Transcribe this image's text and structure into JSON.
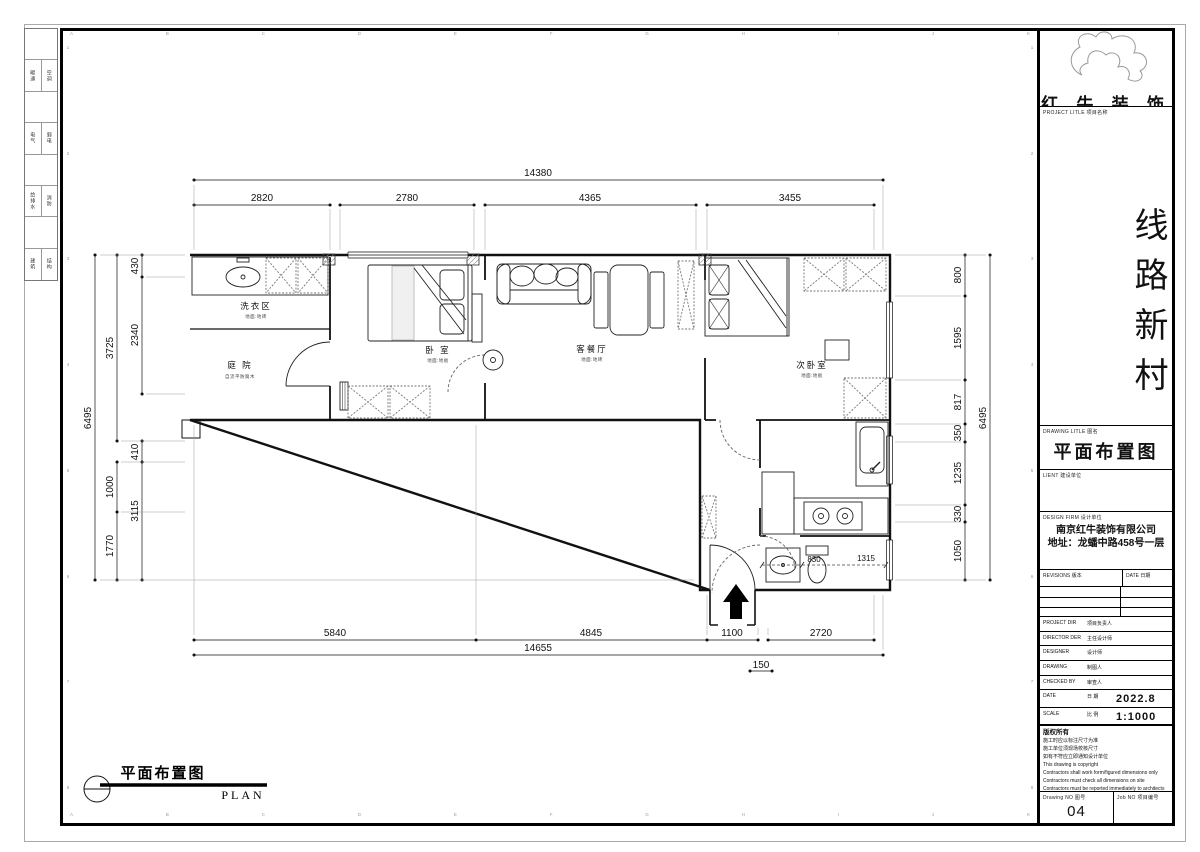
{
  "sign_strip": {
    "rows": [
      {
        "left": "暖通",
        "right": "空调"
      },
      {
        "left": "电气",
        "right": "弱电"
      },
      {
        "left": "给排水",
        "right": "消防"
      },
      {
        "left": "建筑",
        "right": "结构"
      }
    ]
  },
  "frame": {
    "top_letters": [
      "A",
      "B",
      "C",
      "D",
      "E",
      "F",
      "G",
      "H",
      "I",
      "J",
      "K"
    ],
    "bottom_letters": [
      "A",
      "B",
      "C",
      "D",
      "E",
      "F",
      "G",
      "H",
      "I",
      "J",
      "K"
    ],
    "left_numbers": [
      "1",
      "2",
      "3",
      "4",
      "5",
      "6",
      "7",
      "8"
    ],
    "right_numbers": [
      "1",
      "2",
      "3",
      "4",
      "5",
      "6",
      "7",
      "8"
    ]
  },
  "plan": {
    "rooms": [
      {
        "name": "洗衣区",
        "finish": "地面:地砖"
      },
      {
        "name": "庭 院",
        "finish": "自流平防腐木"
      },
      {
        "name": "卧 室",
        "finish": "地面:地板"
      },
      {
        "name": "客餐厅",
        "finish": "地面:地砖"
      },
      {
        "name": "次卧室",
        "finish": "地面:地板"
      }
    ],
    "dims": {
      "top_total": "14380",
      "top_segments": [
        "2820",
        "2780",
        "4365",
        "3455"
      ],
      "left_total": "6495",
      "left_mid": [
        "3725",
        "1000",
        "1770"
      ],
      "left_inner": [
        "430",
        "2340",
        "410",
        "3115"
      ],
      "right_total": "6495",
      "right_inner": [
        "800",
        "1595",
        "817",
        "350",
        "1235",
        "330",
        "1050"
      ],
      "bottom_segments": [
        "5840",
        "4845",
        "1100",
        "2720"
      ],
      "bottom_total": "14655",
      "bottom_offset": "150",
      "interior": [
        "830",
        "1315"
      ]
    },
    "caption": {
      "zh": "平面布置图",
      "en": "PLAN"
    }
  },
  "title_block": {
    "logo_text": "红 牛 装 饰",
    "project_title_label": "PROJECT LITLE 项目名称",
    "project_name": "线路新村",
    "drawing_title_label": "DRAWING LITLE 图名",
    "drawing_title": "平面布置图",
    "client_label": "LIENT 建设单位",
    "design_firm_label": "DESIGN FIRM 设计单位",
    "firm_name": "南京红牛装饰有限公司",
    "firm_address": "地址：龙蟠中路458号一层",
    "revisions_label": "REVISIONS 版本",
    "date_col_label": "DATE 日期",
    "rows": [
      {
        "en": "PROJECT DIR",
        "zh": "项目负责人",
        "value": ""
      },
      {
        "en": "DIRECTOR DER",
        "zh": "主任设计师",
        "value": ""
      },
      {
        "en": "DESIGNER",
        "zh": "设计师",
        "value": ""
      },
      {
        "en": "DRAWING",
        "zh": "制图人",
        "value": ""
      },
      {
        "en": "CHECKED BY",
        "zh": "审查人",
        "value": ""
      },
      {
        "en": "DATE",
        "zh": "日 期",
        "value": "2022.8"
      },
      {
        "en": "SCALE",
        "zh": "比 例",
        "value": "1:1000"
      }
    ],
    "copyright_lines": [
      "版权所有",
      "施工时应以标注尺寸为准",
      "施工单位须现场校核尺寸",
      "如有不符应立即通知设计单位",
      "This drawing is copyright",
      "Contractors shall work form/figured dimensions only",
      "Contractors must check all dimensions on site",
      "Contractors must be reported immediately to architects"
    ],
    "drawing_no_label": "Drawing NO 图号",
    "drawing_no": "04",
    "job_no_label": "Job NO 项目编号"
  }
}
